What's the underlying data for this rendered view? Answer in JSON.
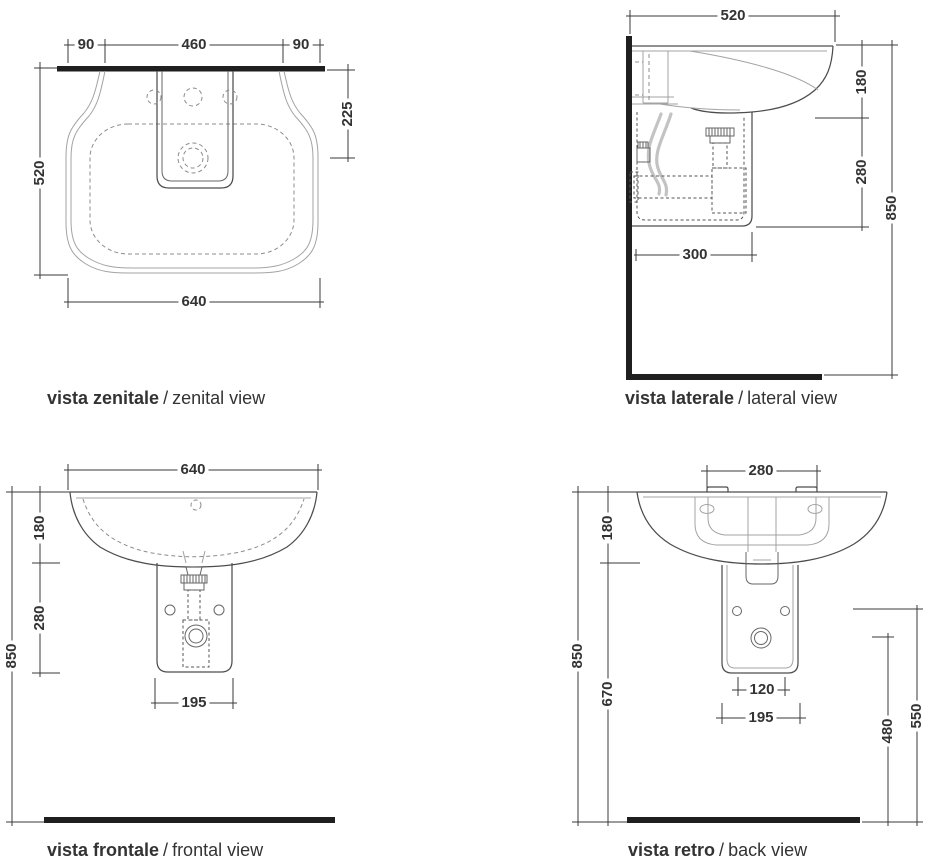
{
  "colors": {
    "dimension_lines": "#3a3a3a",
    "main_outline": "#4d4d4d",
    "secondary_outline": "#a3a3a3",
    "wall_floor_bar": "#1f1f1f"
  },
  "views": {
    "zenital": {
      "caption_it": "vista zenitale",
      "caption_sep": "/",
      "caption_en": "zenital view",
      "dims": {
        "offset_left": "90",
        "tap_span": "460",
        "offset_right": "90",
        "depth": "520",
        "drain_from_wall": "225",
        "width": "640"
      }
    },
    "lateral": {
      "caption_it": "vista laterale",
      "caption_sep": "/",
      "caption_en": "lateral view",
      "dims": {
        "depth": "520",
        "rim_to_bowl_bottom": "180",
        "bowl_to_pedestal_bottom": "280",
        "rim_height": "850",
        "pedestal_depth": "300"
      }
    },
    "frontal": {
      "caption_it": "vista frontale",
      "caption_sep": "/",
      "caption_en": "frontal view",
      "dims": {
        "width": "640",
        "rim_to_bowl_bottom": "180",
        "bowl_to_pedestal_bottom": "280",
        "rim_height": "850",
        "pedestal_width": "195"
      }
    },
    "retro": {
      "caption_it": "vista retro",
      "caption_sep": "/",
      "caption_en": "back view",
      "dims": {
        "fixing_span": "280",
        "rim_to_bowl_bottom": "180",
        "rim_height": "850",
        "bowl_bottom_to_floor": "670",
        "drain_offset": "120",
        "pedestal_width": "195",
        "drain_height": "480",
        "holes_height": "550"
      }
    }
  }
}
